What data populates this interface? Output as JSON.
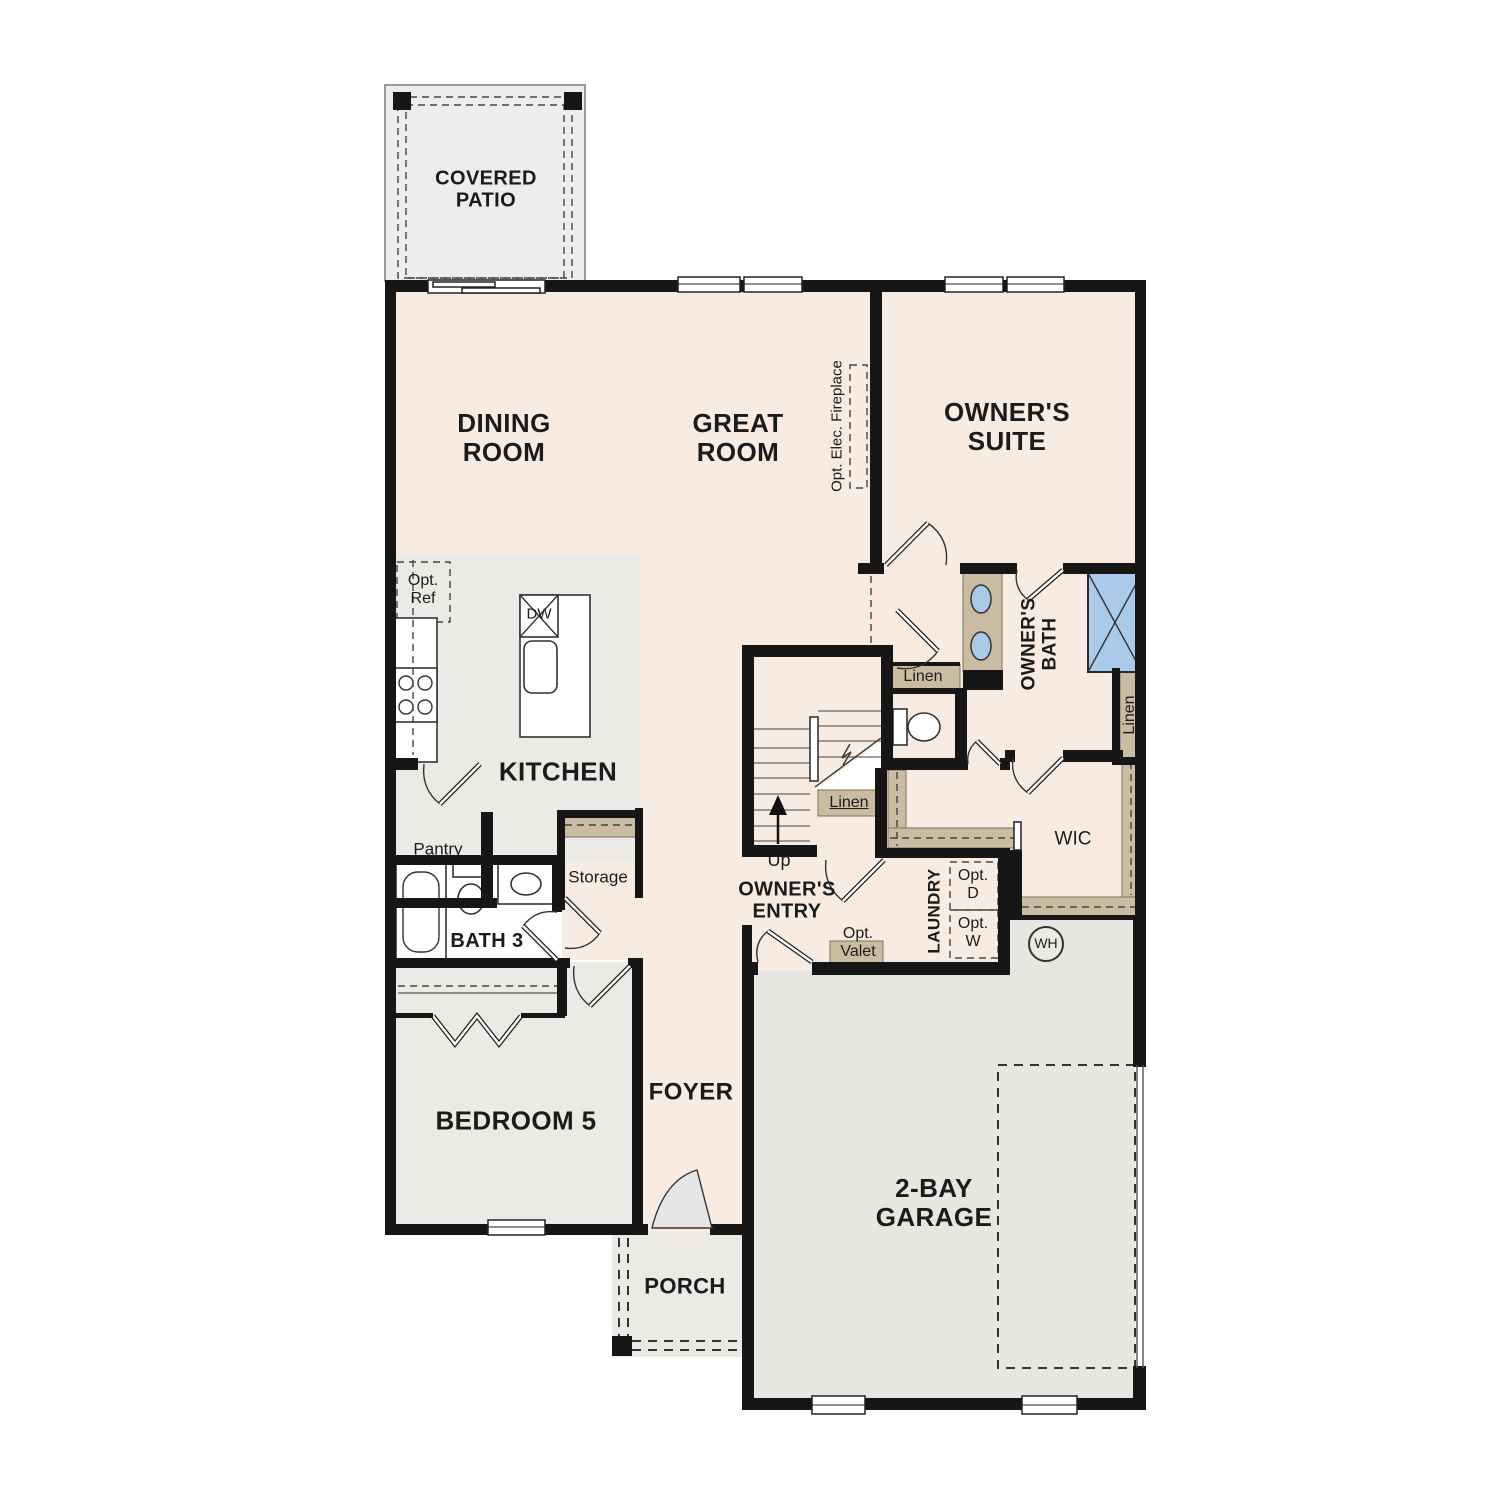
{
  "colors": {
    "floor_cream": "#f8ece2",
    "floor_gray": "#eceae7",
    "floor_garage": "#e8e6e3",
    "floor_patio": "#ededeb",
    "accent_tan": "#c9bca1",
    "fixture_blue": "#a9cbe9",
    "wall_black": "#161616"
  },
  "labels": {
    "covered_patio": "COVERED PATIO",
    "dining_room": "DINING ROOM",
    "great_room": "GREAT ROOM",
    "owners_suite": "OWNER'S SUITE",
    "opt_elec_fireplace": "Opt. Elec. Fireplace",
    "opt_ref": "Opt. Ref",
    "dishwasher": "DW",
    "kitchen": "KITCHEN",
    "pantry": "Pantry",
    "storage": "Storage",
    "bath_3": "BATH 3",
    "owners_bath": "OWNER'S BATH",
    "linen_bath": "Linen",
    "linen_wic": "Linen",
    "linen_stairs": "Linen",
    "wic": "WIC",
    "laundry": "LAUNDRY",
    "opt_dryer": "Opt. D",
    "opt_washer": "Opt. W",
    "water_heater": "WH",
    "opt_valet": "Opt. Valet",
    "owners_entry": "OWNER'S ENTRY",
    "stairs_up": "Up",
    "bedroom_5": "BEDROOM 5",
    "foyer": "FOYER",
    "garage": "2-BAY GARAGE",
    "porch": "PORCH"
  }
}
